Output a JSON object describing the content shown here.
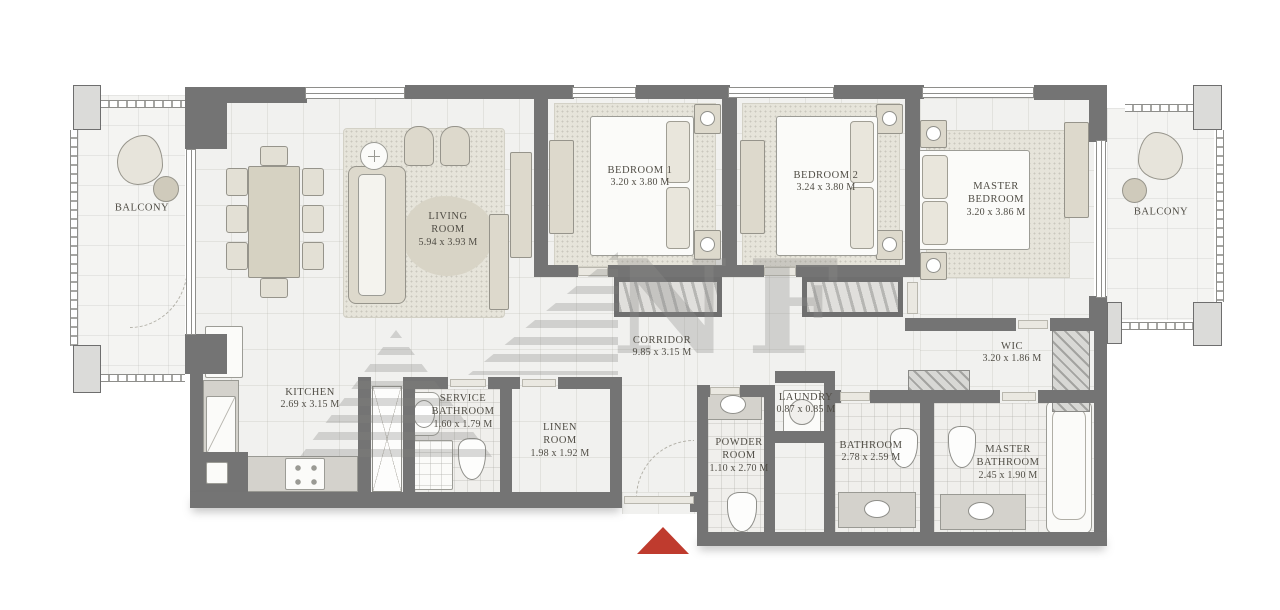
{
  "colors": {
    "wall_gray": "#747474",
    "floor": "#f1f1ef",
    "furniture_beige": "#ddd9cc",
    "carpet": "#e6e4da",
    "entrance_red": "#bf3b2e",
    "label_text": "#504d45"
  },
  "watermark": {
    "text": "NF"
  },
  "rooms": {
    "balcony_left": {
      "name": "BALCONY"
    },
    "living_room": {
      "name": "LIVING ROOM",
      "dims": "5.94 x 3.93 M"
    },
    "bedroom_1": {
      "name": "BEDROOM 1",
      "dims": "3.20 x 3.80 M"
    },
    "bedroom_2": {
      "name": "BEDROOM 2",
      "dims": "3.24 x 3.80 M"
    },
    "master_bedroom": {
      "name": "MASTER BEDROOM",
      "dims": "3.20 x 3.86 M"
    },
    "balcony_right": {
      "name": "BALCONY"
    },
    "wic": {
      "name": "WIC",
      "dims": "3.20 x 1.86 M"
    },
    "kitchen": {
      "name": "KITCHEN",
      "dims": "2.69 x 3.15 M"
    },
    "corridor": {
      "name": "CORRIDOR",
      "dims": "9.85 x 3.15 M"
    },
    "service_bathroom": {
      "name": "SERVICE BATHROOM",
      "dims": "1.60 x 1.79 M"
    },
    "linen_room": {
      "name": "LINEN ROOM",
      "dims": "1.98 x 1.92 M"
    },
    "powder_room": {
      "name": "POWDER ROOM",
      "dims": "1.10 x 2.70 M"
    },
    "laundry": {
      "name": "LAUNDRY",
      "dims": "0.87 x 0.85 M"
    },
    "bathroom": {
      "name": "BATHROOM",
      "dims": "2.78 x 2.59 M"
    },
    "master_bathroom": {
      "name": "MASTER BATHROOM",
      "dims": "2.45 x 1.90 M"
    }
  }
}
